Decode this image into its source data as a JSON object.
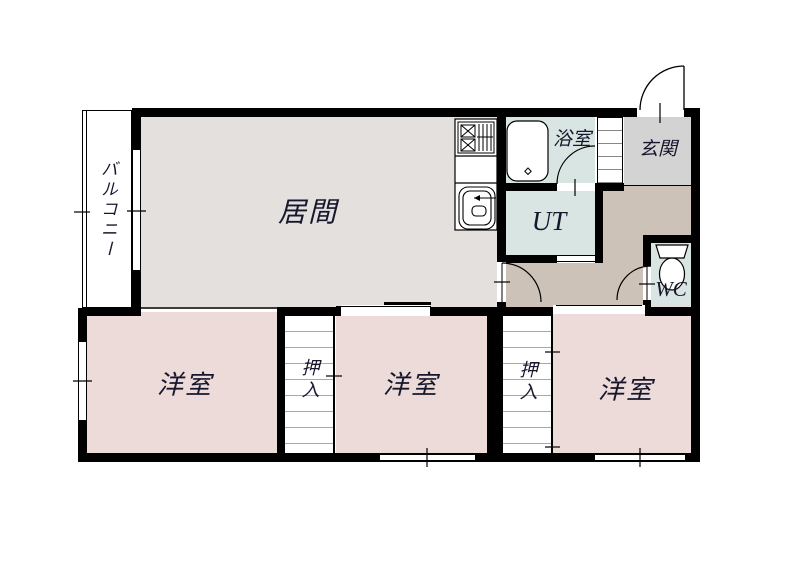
{
  "plan_type": "floor-plan",
  "rooms": {
    "balcony": {
      "label": "バルコニー"
    },
    "living": {
      "label": "居間"
    },
    "bath": {
      "label": "浴室"
    },
    "entrance": {
      "label": "玄関"
    },
    "utility": {
      "label": "UT"
    },
    "wc": {
      "label": "WC"
    },
    "closet1": {
      "label": "押入"
    },
    "closet2": {
      "label": "押入"
    },
    "western1": {
      "label": "洋室"
    },
    "western2": {
      "label": "洋室"
    },
    "western3": {
      "label": "洋室"
    }
  },
  "colors": {
    "wall": "#000000",
    "living_floor": "#e4e0de",
    "western_floor": "#ecdbd9",
    "wet_area_floor": "#d9e5e2",
    "entrance_floor": "#d3d3d3",
    "hallway_floor": "#ccc2b8",
    "label_text": "#16162c"
  }
}
